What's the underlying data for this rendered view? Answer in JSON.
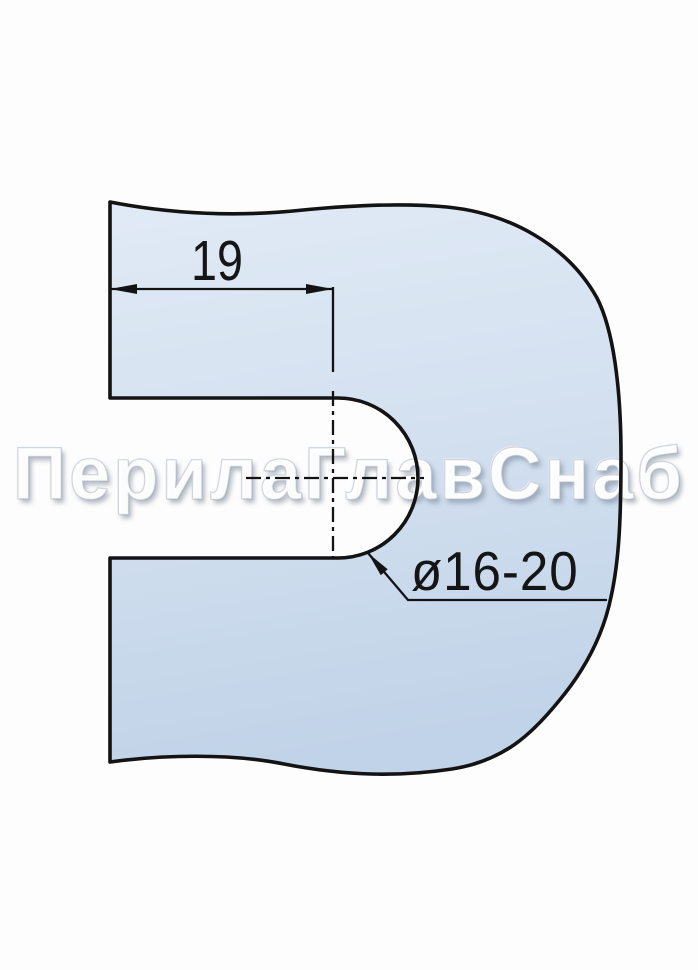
{
  "drawing": {
    "width_dimension_label": "19",
    "diameter_dimension_label": "ø16-20",
    "watermark_text": "ПерилаГлавСнаб"
  },
  "colors": {
    "background": "#fdfdfd",
    "part_fill_light": "#e1eaf6",
    "part_fill_mid": "#d4e1f0",
    "part_fill_dark": "#c1d3e8",
    "line": "#131313",
    "watermark": "#ffffff"
  }
}
